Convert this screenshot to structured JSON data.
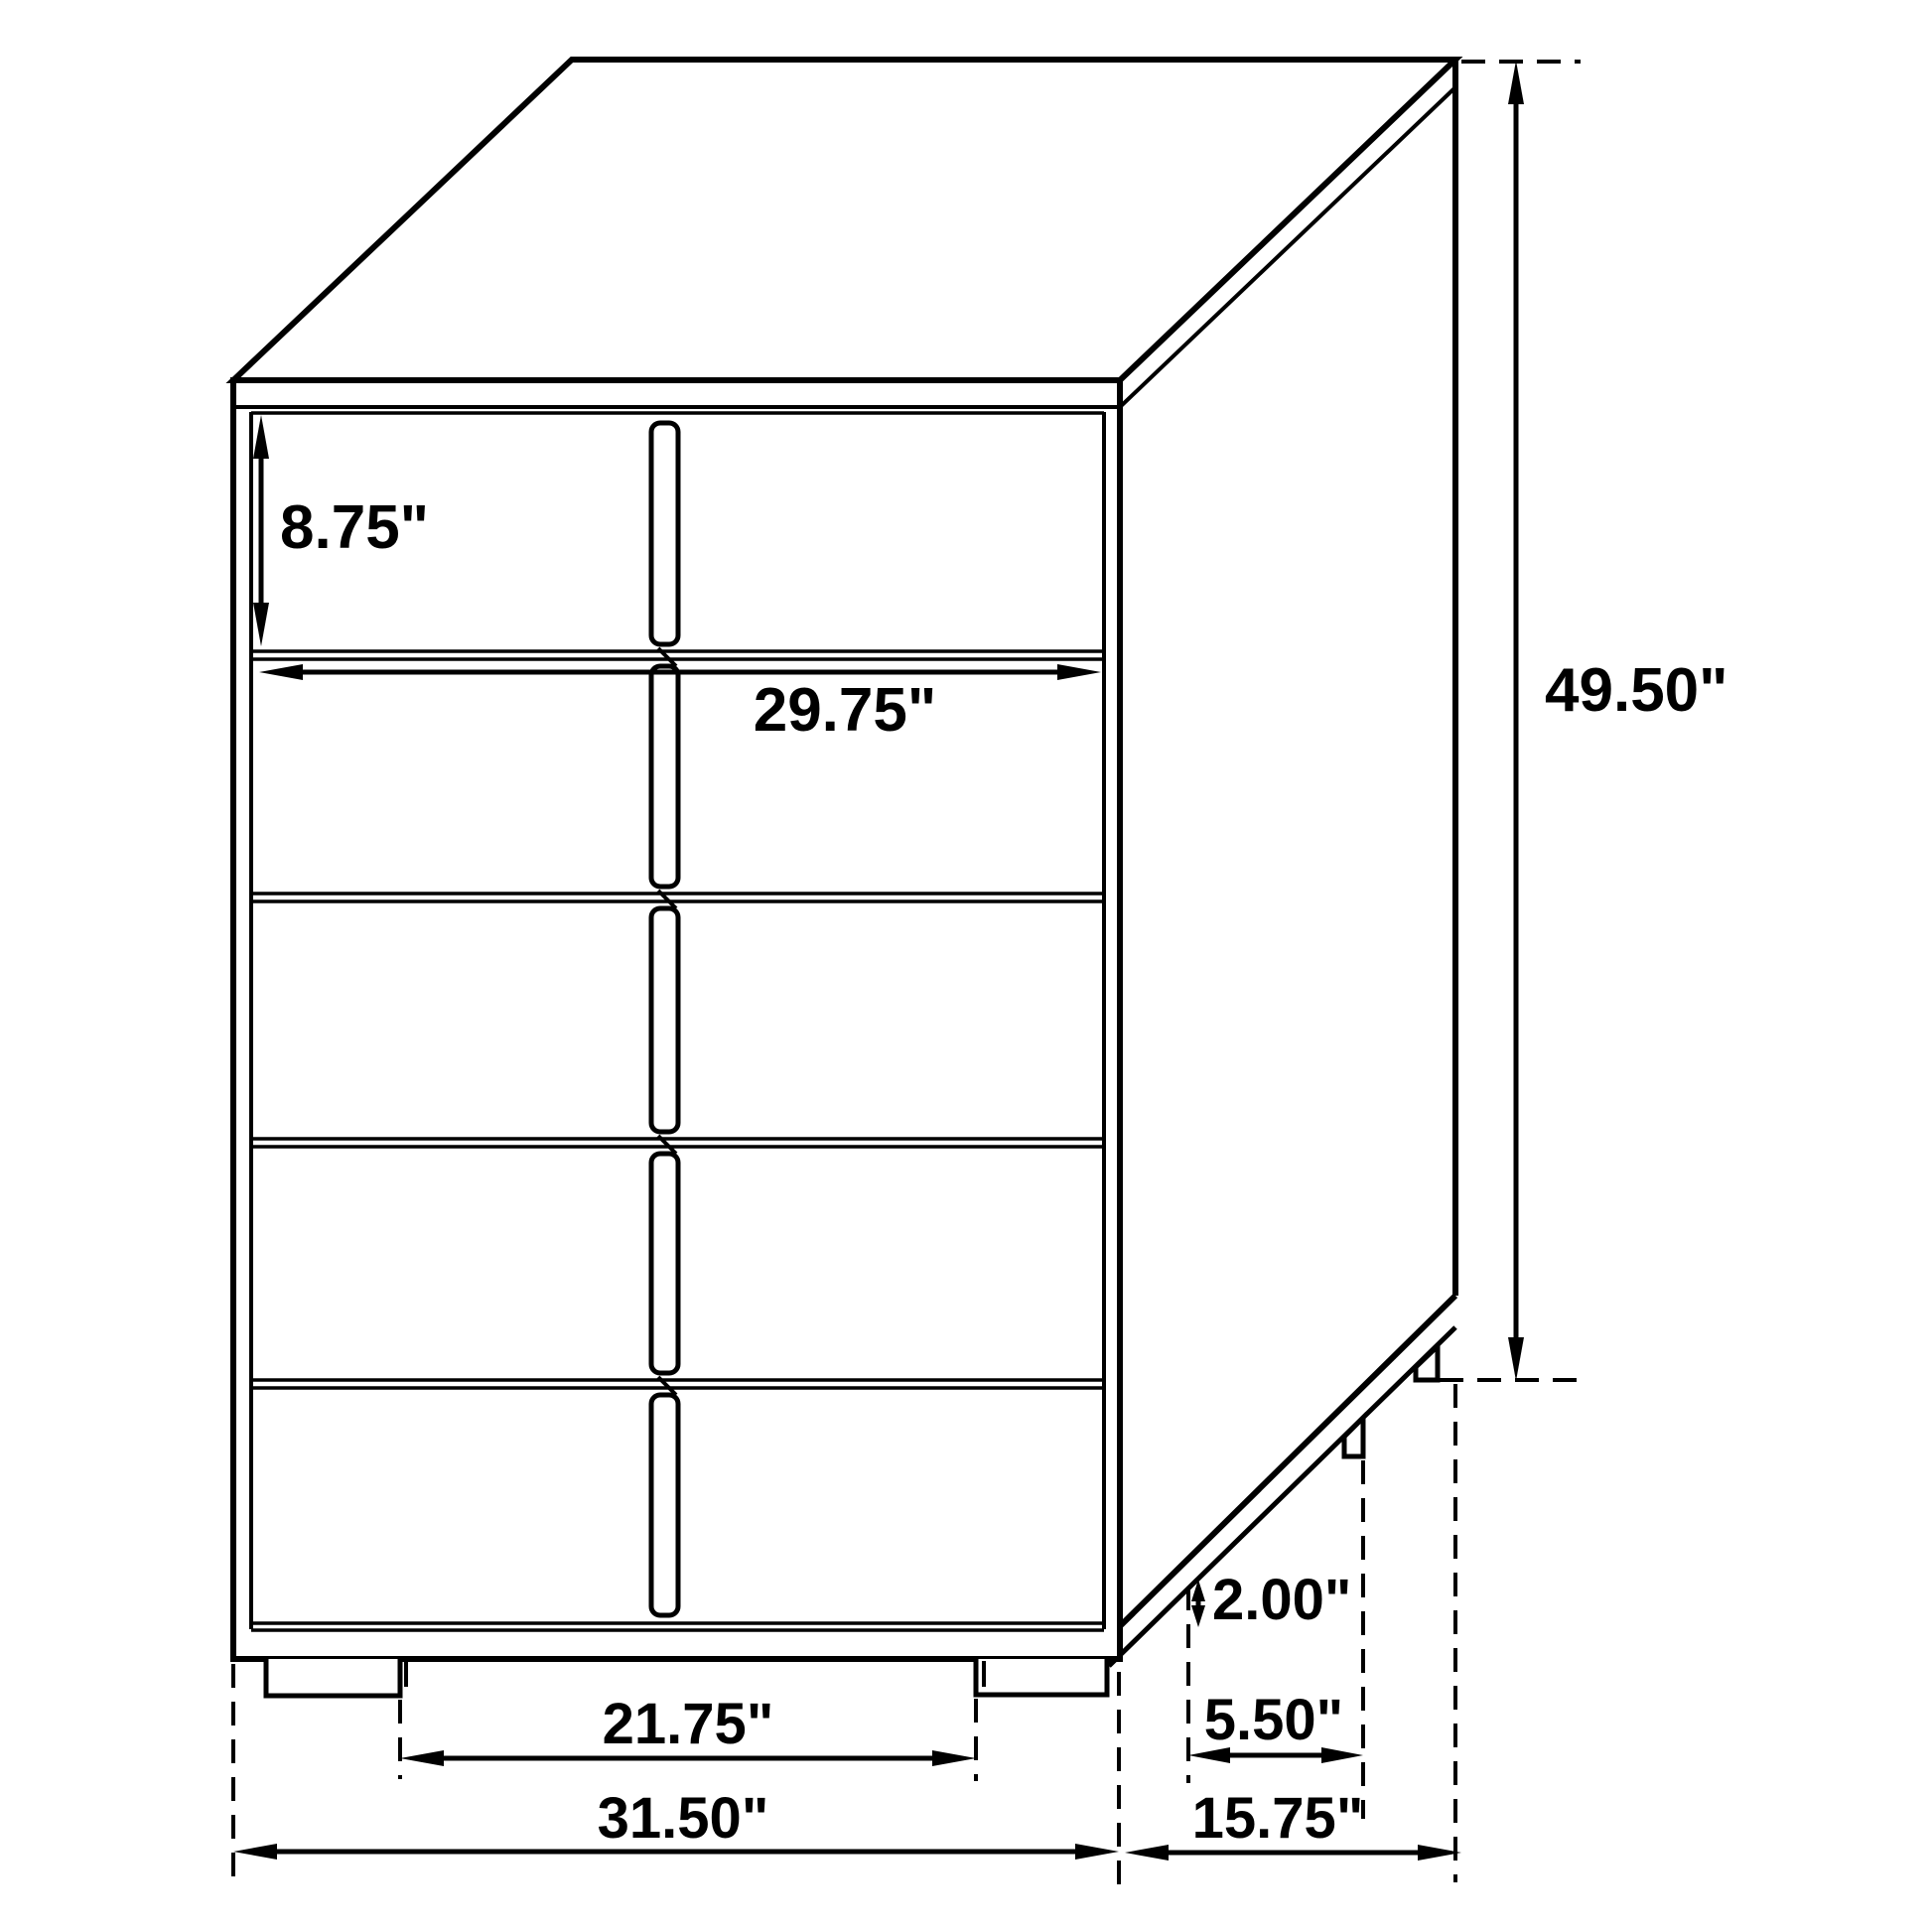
{
  "diagram": {
    "type": "furniture-dimension-drawing",
    "subject": "five-drawer-chest",
    "colors": {
      "line": "#000000",
      "background": "#ffffff"
    },
    "dimensions": {
      "drawer_height": "8.75\"",
      "drawer_width": "29.75\"",
      "overall_height": "49.50\"",
      "foot_height": "2.00\"",
      "side_foot_inset": "5.50\"",
      "front_feet_span": "21.75\"",
      "overall_width": "31.50\"",
      "overall_depth": "15.75\""
    }
  }
}
